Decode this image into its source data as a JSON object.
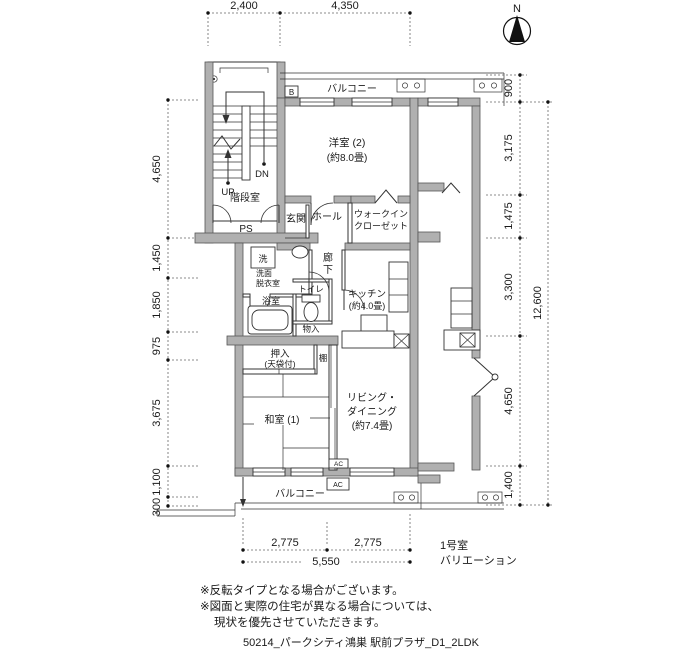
{
  "compass": {
    "north": "N"
  },
  "dimensions": {
    "top": [
      "2,400",
      "4,350"
    ],
    "left": [
      "4,650",
      "1,450",
      "1,850",
      "975",
      "3,675",
      "1,100",
      "300"
    ],
    "right": [
      "900",
      "3,175",
      "1,475",
      "3,300",
      "4,650",
      "1,400"
    ],
    "right_overall": "12,600",
    "bottom": [
      "2,775",
      "2,775"
    ],
    "bottom_total": "5,550"
  },
  "rooms": {
    "balcony_top": "バルコニー",
    "balcony_bottom": "バルコニー",
    "western_room": {
      "name": "洋室 (2)",
      "size": "(約8.0畳)"
    },
    "entrance": "玄関",
    "hall": "ホール",
    "wic": {
      "line1": "ウォークイン",
      "line2": "クローゼット"
    },
    "stairwell": "階段室",
    "ps": "PS",
    "up": "UP",
    "dn": "DN",
    "meter_box": "B",
    "corridor": {
      "char1": "廊",
      "char2": "下"
    },
    "washer": "洗",
    "washroom": {
      "line1": "洗面",
      "line2": "脱衣室"
    },
    "bathroom": "浴室",
    "toilet": "トイレ",
    "kitchen": {
      "name": "キッチン",
      "size": "(約4.0畳)"
    },
    "storage": "物入",
    "closet": {
      "line1": "押入",
      "line2": "(天袋付)"
    },
    "shelf": "棚",
    "japanese_room": "和室 (1)",
    "living": {
      "line1": "リビング・",
      "line2": "ダイニング",
      "size": "(約7.4畳)"
    },
    "ac": "AC"
  },
  "annotations": {
    "room_variation": {
      "line1": "1号室",
      "line2": "バリエーション"
    },
    "notes": [
      "※反転タイプとなる場合がございます。",
      "※図面と実際の住宅が異なる場合については、",
      "現状を優先させていただきます。"
    ],
    "plan_id": "50214_パークシティ鴻巣 駅前プラザ_D1_2LDK"
  },
  "colors": {
    "wall": "#b0b0b0",
    "line": "#333333",
    "dim": "#555555",
    "background": "#ffffff"
  }
}
